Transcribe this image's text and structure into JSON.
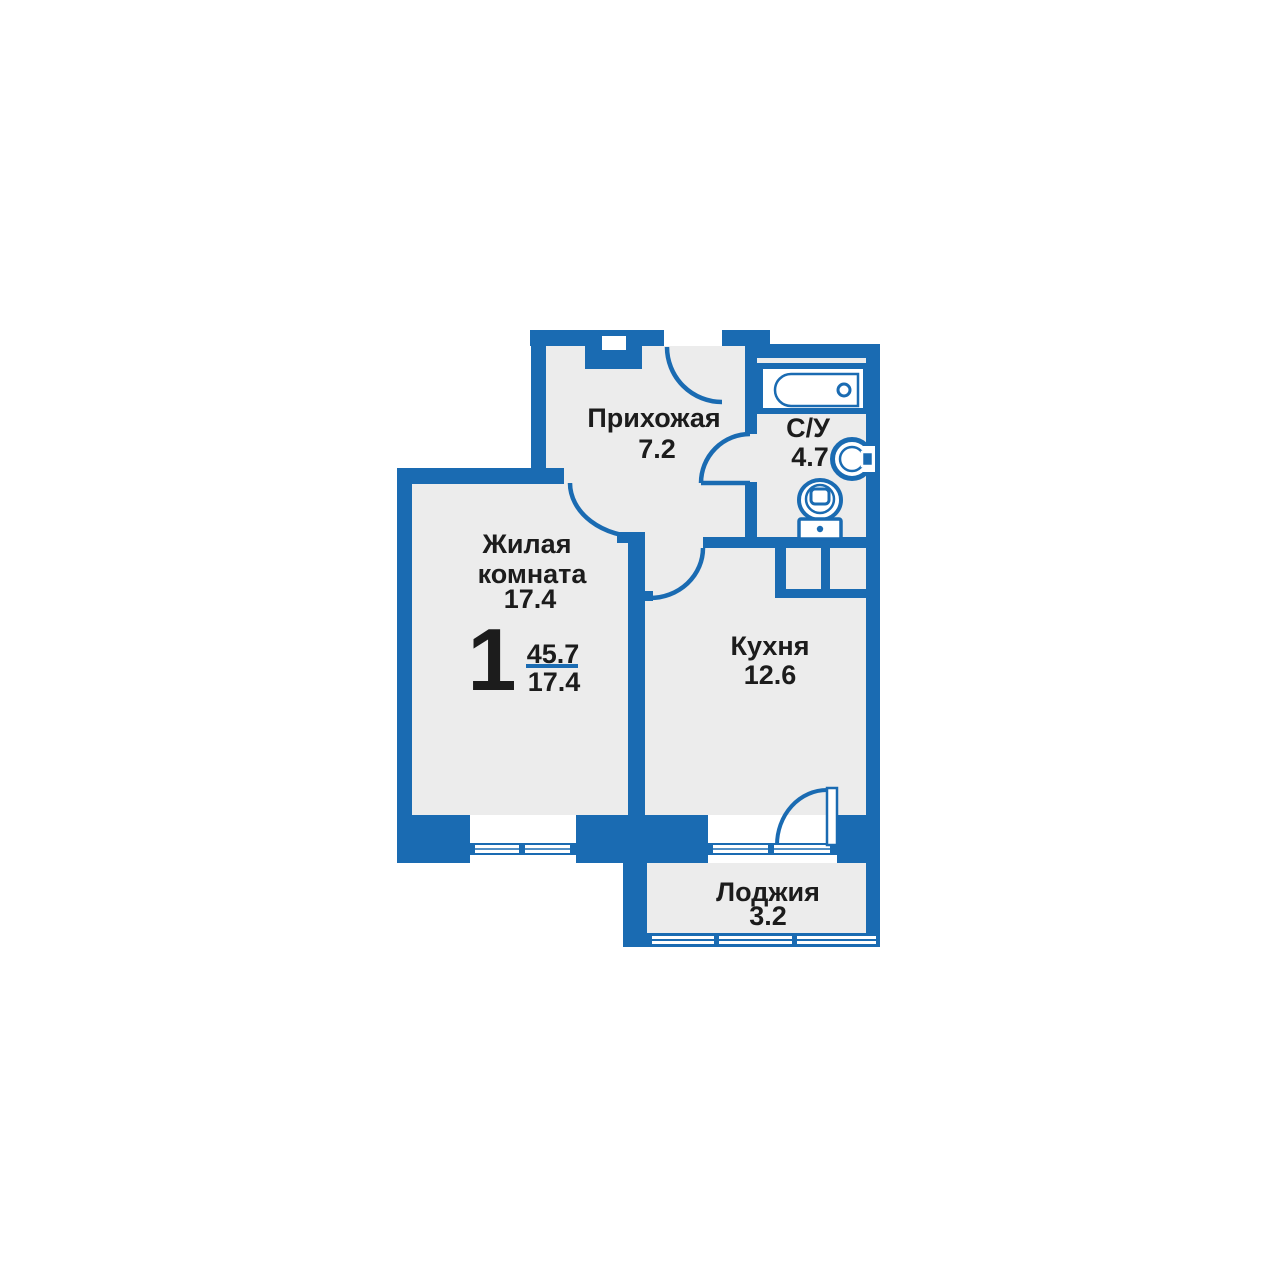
{
  "apartment_plan": {
    "title": "1-room apartment floor plan",
    "summary": {
      "rooms_count": "1",
      "area_total": "45.7",
      "area_living": "17.4"
    },
    "rooms": {
      "hallway": {
        "name": "Прихожая",
        "area": "7.2"
      },
      "bathroom": {
        "name": "С/У",
        "area": "4.7"
      },
      "living": {
        "name_line1": "Жилая",
        "name_line2": "комната",
        "area": "17.4"
      },
      "kitchen": {
        "name": "Кухня",
        "area": "12.6"
      },
      "loggia": {
        "name": "Лоджия",
        "area": "3.2"
      }
    },
    "fixtures": {
      "bathtub": "bathtub-icon",
      "toilet": "toilet-icon",
      "washbasin": "washbasin-icon",
      "entry_door": "entry-door-arc",
      "living_door": "living-door-arc",
      "bathroom_door": "bathroom-door-arc",
      "kitchen_door": "kitchen-door-arc",
      "balcony_door": "balcony-door-arc",
      "living_window": "living-window",
      "kitchen_window": "kitchen-window",
      "loggia_glazing": "loggia-glazing"
    },
    "colors": {
      "wall_blue": "#1a6bb2",
      "floor_gray": "#ececec",
      "text_black": "#1c1c1c",
      "background": "#ffffff"
    }
  }
}
